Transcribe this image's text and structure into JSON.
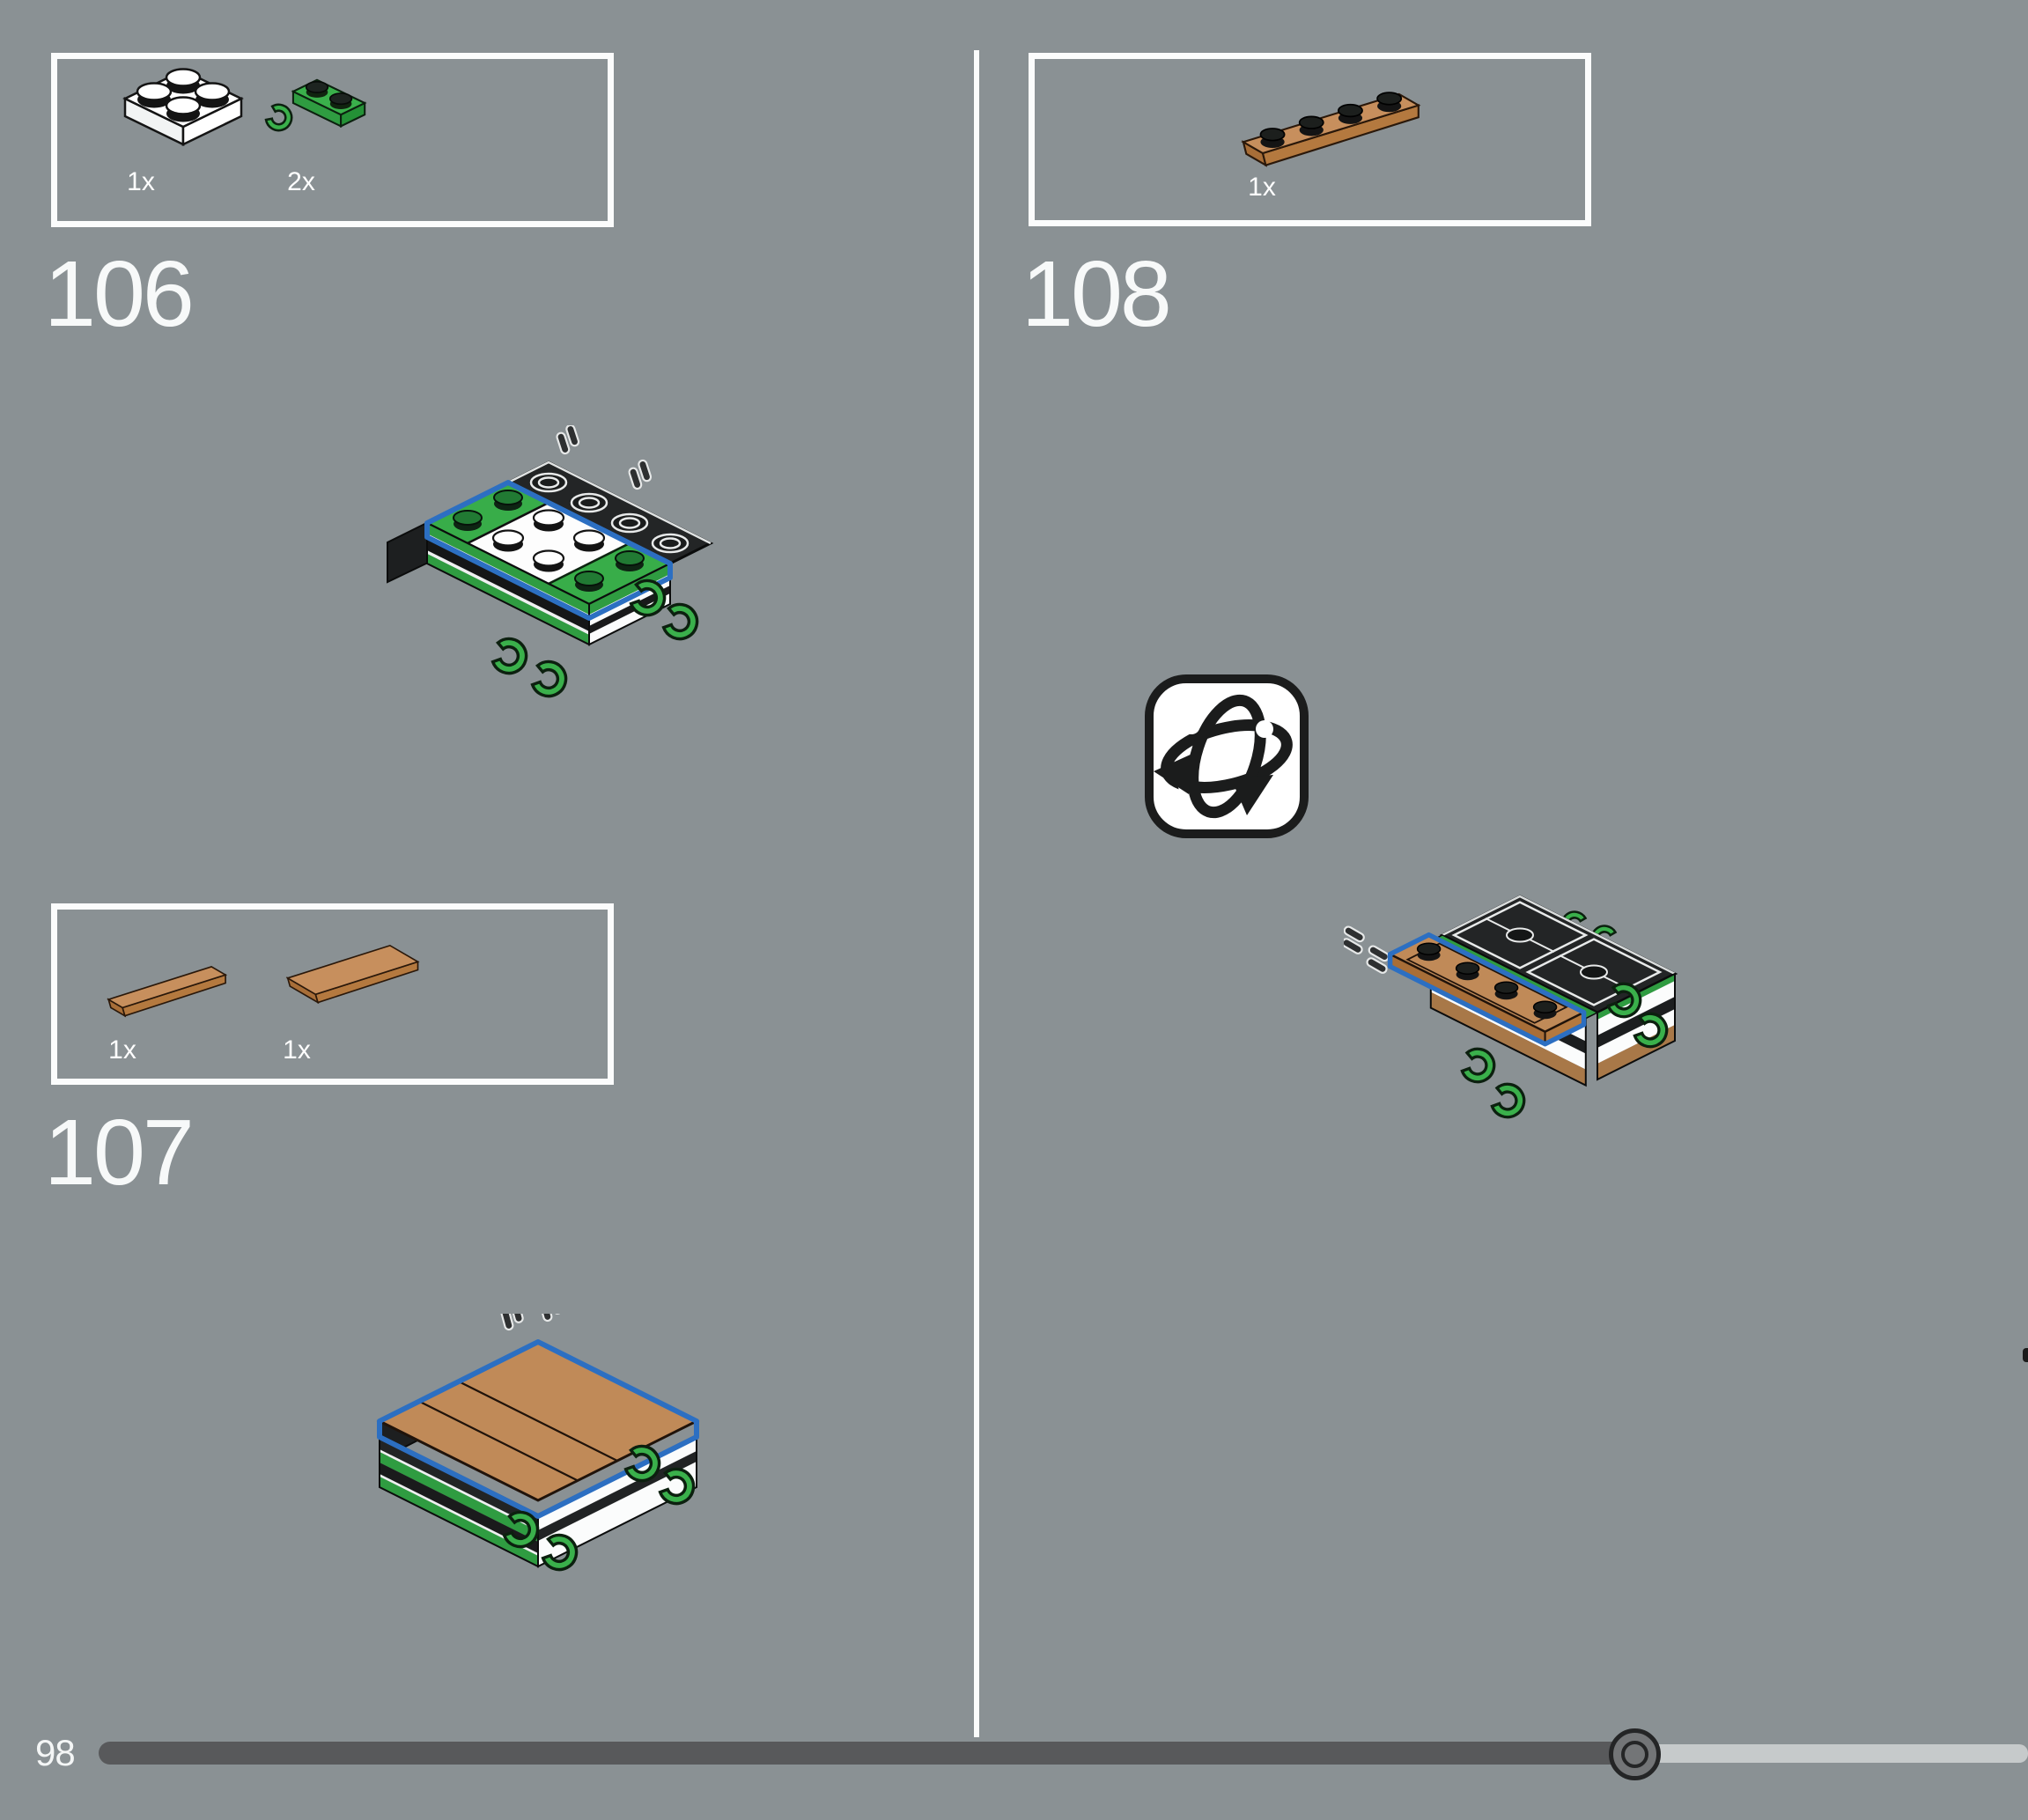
{
  "steps": {
    "s106": {
      "number": "106",
      "parts": [
        {
          "count": "1x",
          "name": "white-2x2-plate"
        },
        {
          "count": "2x",
          "name": "green-1x2-plate-with-clip"
        }
      ]
    },
    "s107": {
      "number": "107",
      "parts": [
        {
          "count": "1x",
          "name": "nougat-1x4-tile"
        },
        {
          "count": "1x",
          "name": "nougat-2x4-tile"
        }
      ]
    },
    "s108": {
      "number": "108",
      "parts": [
        {
          "count": "1x",
          "name": "nougat-1x4-plate"
        }
      ],
      "icon": "rotate-model"
    }
  },
  "footer": {
    "page_number": "98",
    "progress_percent": 80
  },
  "colors": {
    "background": "#8a9194",
    "box_border": "#fbfcfc",
    "highlight_blue": "#2c6fc2",
    "lego_green": "#3ab04b",
    "nougat": "#c08a58",
    "track_dark": "#58595b",
    "track_light": "#c6cacb"
  }
}
